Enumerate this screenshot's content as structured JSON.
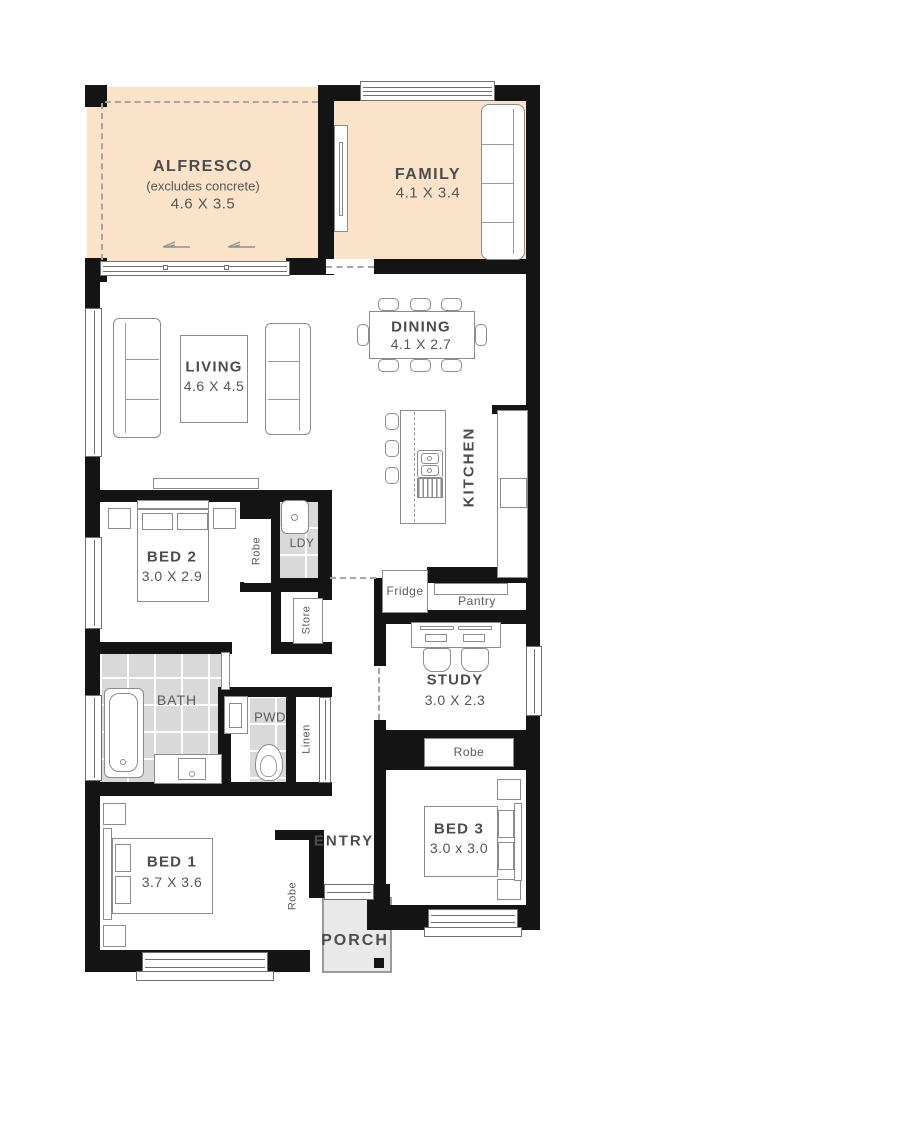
{
  "plan": {
    "title": "Single storey house floor plan",
    "rooms": {
      "alfresco": {
        "name": "ALFRESCO",
        "note": "(excludes concrete)",
        "dims": "4.6 X 3.5"
      },
      "family": {
        "name": "FAMILY",
        "dims": "4.1 X 3.4"
      },
      "dining": {
        "name": "DINING",
        "dims": "4.1 X 2.7"
      },
      "living": {
        "name": "LIVING",
        "dims": "4.6 X 4.5"
      },
      "kitchen": {
        "name": "KITCHEN"
      },
      "bed2": {
        "name": "BED 2",
        "dims": "3.0 X 2.9"
      },
      "bed1": {
        "name": "BED 1",
        "dims": "3.7 X 3.6"
      },
      "bed3": {
        "name": "BED 3",
        "dims": "3.0 x 3.0"
      },
      "study": {
        "name": "STUDY",
        "dims": "3.0 X 2.3"
      },
      "bath": {
        "name": "BATH"
      },
      "pwd": {
        "name": "PWD"
      },
      "ldy": {
        "name": "LDY"
      },
      "linen": {
        "name": "Linen"
      },
      "store": {
        "name": "Store"
      },
      "fridge": {
        "name": "Fridge"
      },
      "pantry": {
        "name": "Pantry"
      },
      "entry": {
        "name": "ENTRY"
      },
      "porch": {
        "name": "PORCH"
      },
      "robe_bed1": {
        "name": "Robe"
      },
      "robe_bed2": {
        "name": "Robe"
      },
      "robe_bed3": {
        "name": "Robe"
      }
    },
    "colors": {
      "room_highlight_fill": "#fbe3ca",
      "wall": "#141414",
      "tile": "#d9d9d9",
      "porch": "#e9e9e9"
    }
  }
}
